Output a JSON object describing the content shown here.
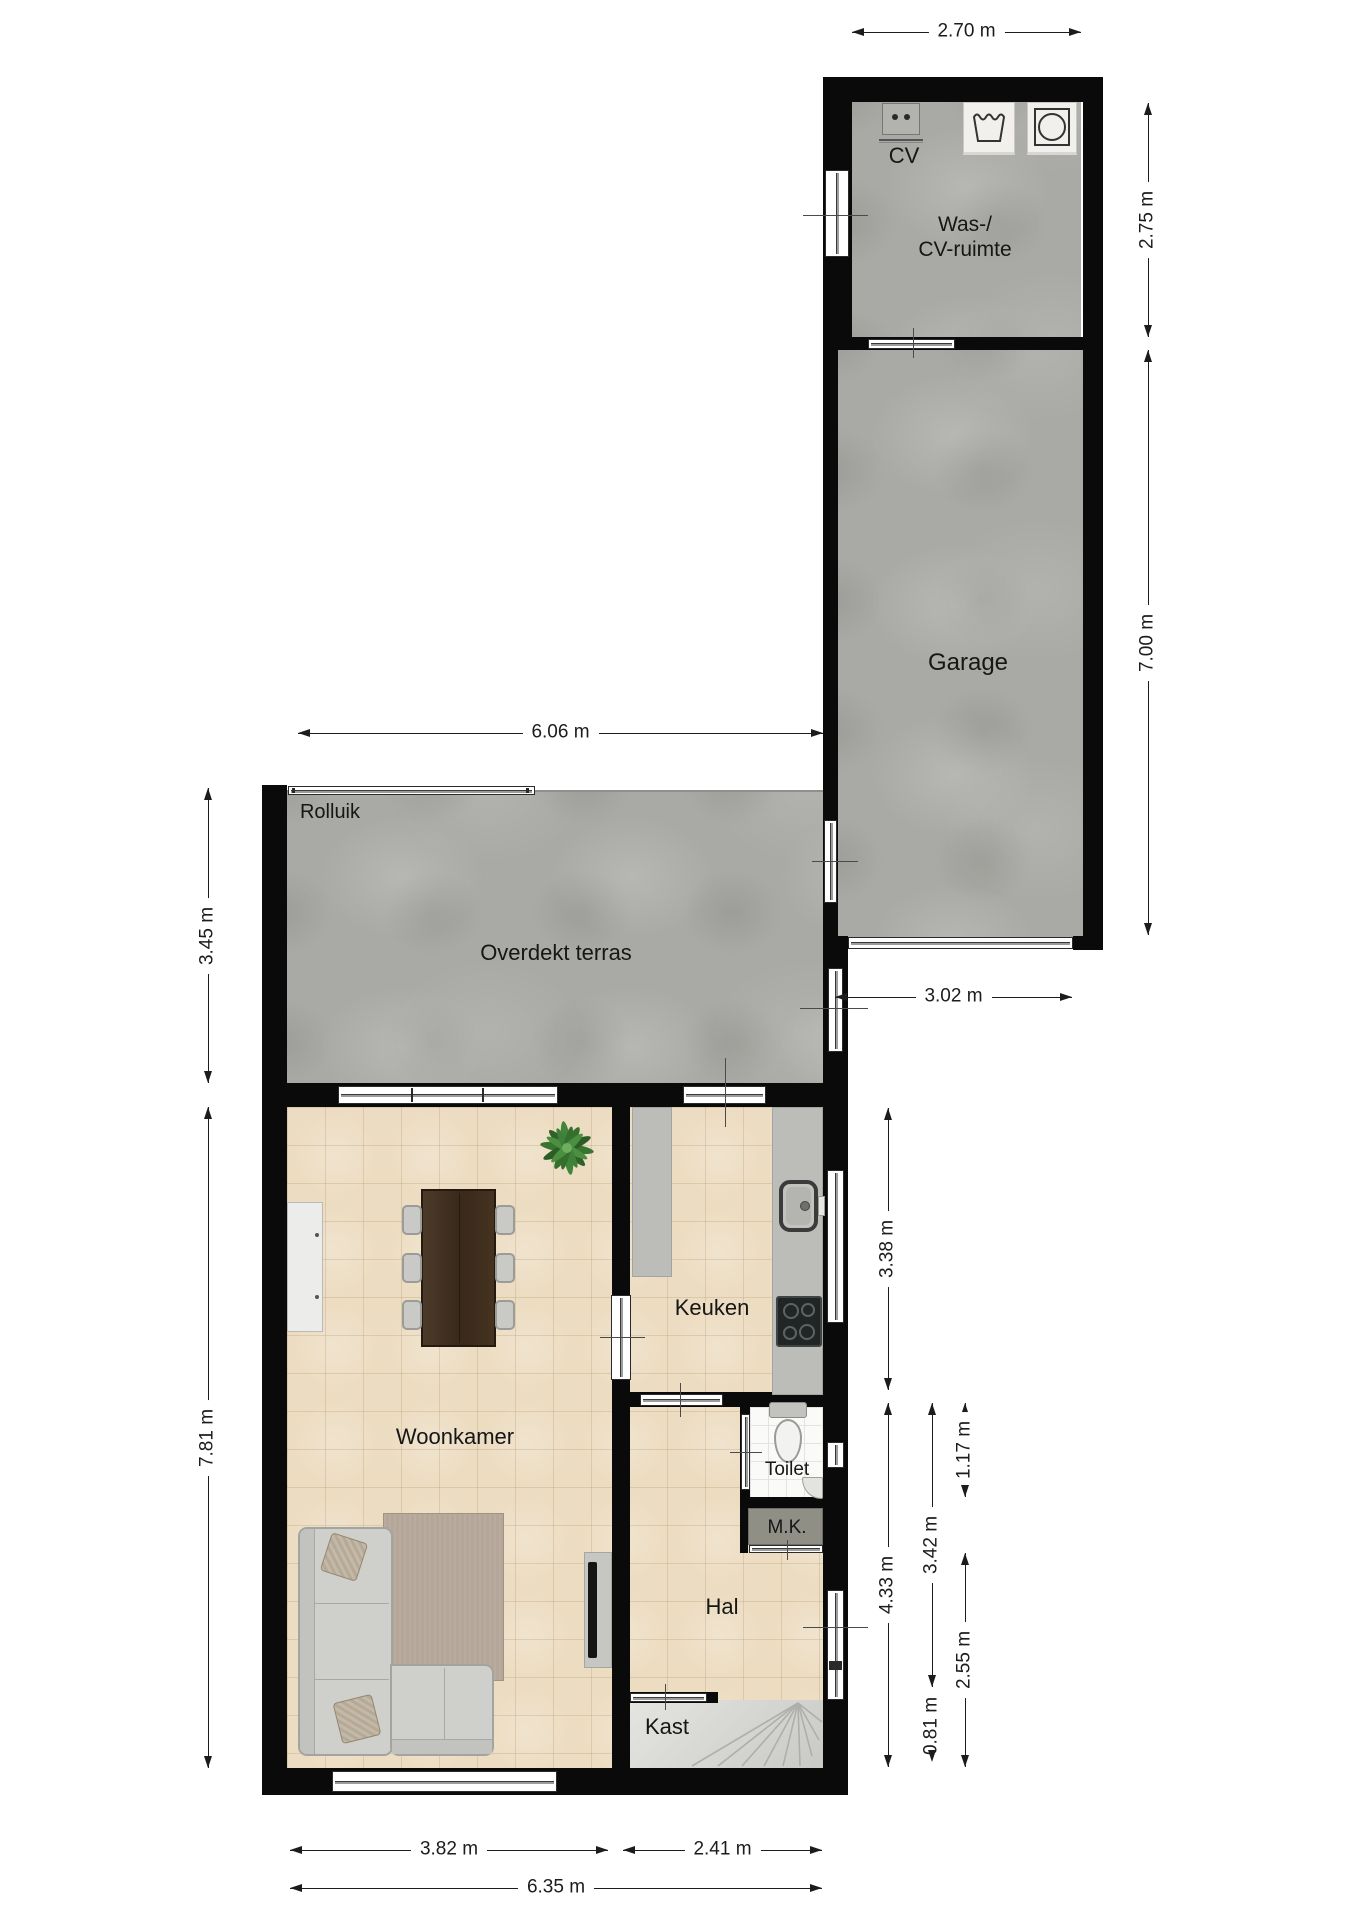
{
  "rooms": {
    "laundry": {
      "name": "Was-/\nCV-ruimte"
    },
    "cv_unit": {
      "label": "CV"
    },
    "garage": {
      "name": "Garage"
    },
    "terrace": {
      "name": "Overdekt terras"
    },
    "shutter": {
      "label": "Rolluik"
    },
    "living_room": {
      "name": "Woonkamer"
    },
    "kitchen": {
      "name": "Keuken"
    },
    "toilet": {
      "name": "Toilet"
    },
    "meter_closet": {
      "name": "M.K."
    },
    "hall": {
      "name": "Hal"
    },
    "closet": {
      "name": "Kast"
    }
  },
  "dimensions": {
    "laundry_width": "2.70 m",
    "laundry_height": "2.75 m",
    "garage_height": "7.00 m",
    "garage_width": "3.02 m",
    "terrace_width": "6.06 m",
    "terrace_height": "3.45 m",
    "house_height": "7.81 m",
    "kitchen_height": "3.38 m",
    "hall_full_height": "4.33 m",
    "hall_mid_height": "3.42 m",
    "toilet_height": "1.17 m",
    "entry_height": "2.55 m",
    "stairs_depth": "0.81 m",
    "living_width": "3.82 m",
    "hall_width": "2.41 m",
    "house_width": "6.35 m"
  },
  "colors": {
    "wall": "#0a0a0a",
    "dim": "#1c1c1c",
    "concrete": "#a9a9a5",
    "tile": "#ecdcc1",
    "counter": "#bcbcb8",
    "stairs": "#d9d9d6",
    "rug": "#b4a698",
    "sofa": "#cfcfcc",
    "table": "#46331f",
    "plant": "#3c7c35"
  }
}
